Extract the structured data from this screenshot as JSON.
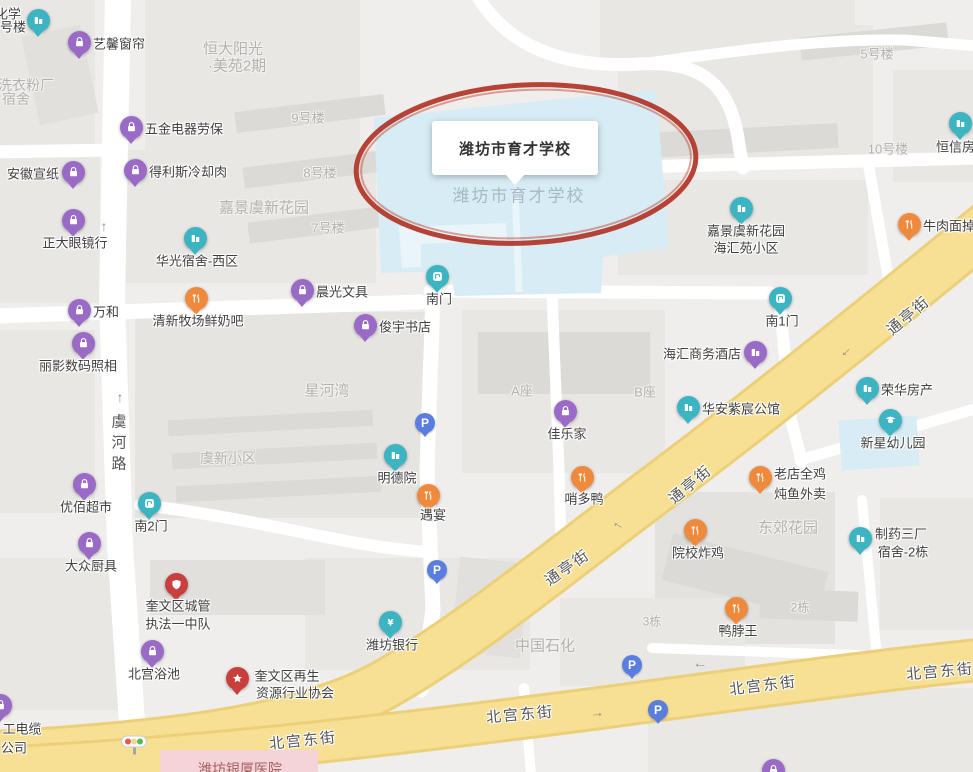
{
  "school": {
    "callout_label": "潍坊市育才学校",
    "ghost_label": "潍坊市育才学校"
  },
  "colors": {
    "pin_purple": "#9a6bc6",
    "pin_teal": "#3db4c2",
    "pin_orange": "#ef8a3d",
    "pin_red": "#c8403e",
    "parking_blue": "#5a7de0",
    "road_yellow": "#f7e093",
    "campus_blue": "#d7ecf4",
    "highlight_ellipse": "#b3392c",
    "hospital_pink": "#f4d4d9"
  },
  "pois": [
    {
      "id": "chem-dorm",
      "lines": [
        {
          "t": "化学",
          "x": 8,
          "y": 13
        },
        {
          "t": "号楼",
          "x": 13,
          "y": 26
        }
      ],
      "icon": "building",
      "color": "teal",
      "x": 38,
      "y": 20
    },
    {
      "id": "yixin-curtains",
      "label": "艺馨窗帘",
      "icon": "bag",
      "color": "purple",
      "x": 79,
      "y": 42,
      "lp": "r"
    },
    {
      "id": "wujin-labor",
      "label": "五金电器劳保",
      "icon": "bag",
      "color": "purple",
      "x": 131,
      "y": 127,
      "lp": "r"
    },
    {
      "id": "anhui-paper",
      "label": "安徽宣纸",
      "icon": "bag",
      "color": "purple",
      "x": 73,
      "y": 172,
      "lp": "l"
    },
    {
      "id": "delisi-meat",
      "label": "得利斯冷却肉",
      "icon": "bag",
      "color": "purple",
      "x": 135,
      "y": 170,
      "lp": "r"
    },
    {
      "id": "zhengda-glasses",
      "label": "正大眼镜行",
      "icon": "bag",
      "color": "purple",
      "x": 73,
      "y": 220,
      "lp": "b"
    },
    {
      "id": "wanhe",
      "label": "万和",
      "icon": "bag",
      "color": "purple",
      "x": 79,
      "y": 310,
      "lp": "r"
    },
    {
      "id": "liying-photo",
      "label": "丽影数码照相",
      "icon": "bag",
      "color": "purple",
      "x": 83,
      "y": 343,
      "lp": "b",
      "lx": 78,
      "ly": 365
    },
    {
      "id": "chenguang-stationery",
      "label": "晨光文具",
      "icon": "bag",
      "color": "purple",
      "x": 302,
      "y": 290,
      "lp": "r"
    },
    {
      "id": "junyu-bookstore",
      "label": "俊宇书店",
      "icon": "bag",
      "color": "purple",
      "x": 365,
      "y": 325,
      "lp": "r"
    },
    {
      "id": "youbai-market",
      "label": "优佰超市",
      "icon": "bag",
      "color": "purple",
      "x": 84,
      "y": 484,
      "lp": "b"
    },
    {
      "id": "dazhong-kitchen",
      "label": "大众厨具",
      "icon": "bag",
      "color": "purple",
      "x": 89,
      "y": 543,
      "lp": "b"
    },
    {
      "id": "jialejia",
      "label": "佳乐家",
      "icon": "bag",
      "color": "purple",
      "x": 565,
      "y": 411,
      "lp": "b"
    },
    {
      "id": "haihui-hotel",
      "label": "海汇商务酒店",
      "icon": "building",
      "color": "purple",
      "x": 755,
      "y": 352,
      "lp": "l"
    },
    {
      "id": "beigong-bath",
      "label": "北宫浴池",
      "icon": "bag",
      "color": "purple",
      "x": 152,
      "y": 651,
      "lp": "b"
    },
    {
      "id": "cable-company",
      "lines": [
        {
          "t": "工电缆",
          "x": 22,
          "y": 728
        },
        {
          "t": "公司",
          "x": 14,
          "y": 747
        }
      ],
      "icon": "bag",
      "color": "purple",
      "x": 0,
      "y": 705
    },
    {
      "id": "edge-shop",
      "icon": "bag",
      "color": "purple",
      "x": 773,
      "y": 770
    },
    {
      "id": "huaguang-dorm",
      "label": "华光宿舍-西区",
      "icon": "building",
      "color": "teal",
      "x": 195,
      "y": 238,
      "lp": "b"
    },
    {
      "id": "mingde-yuan",
      "label": "明德院",
      "icon": "building",
      "color": "teal",
      "x": 395,
      "y": 455,
      "lp": "b"
    },
    {
      "id": "south-gate",
      "label": "南门",
      "icon": "gate",
      "color": "teal",
      "x": 437,
      "y": 276,
      "lp": "b"
    },
    {
      "id": "south-gate-2",
      "label": "南2门",
      "icon": "gate",
      "color": "teal",
      "x": 149,
      "y": 503,
      "lp": "b"
    },
    {
      "id": "south-gate-1",
      "label": "南1门",
      "icon": "gate",
      "color": "teal",
      "x": 780,
      "y": 298,
      "lp": "b"
    },
    {
      "id": "jiajing-haihuiyuan",
      "lines": [
        {
          "t": "嘉景虞新花园",
          "x": 746,
          "y": 230
        },
        {
          "t": "海汇苑小区",
          "x": 746,
          "y": 247
        }
      ],
      "icon": "building",
      "color": "teal",
      "x": 741,
      "y": 208
    },
    {
      "id": "hengxin-realty",
      "label": "恒信房产",
      "icon": "building",
      "color": "teal",
      "x": 960,
      "y": 123,
      "lp": "b",
      "lx": 962,
      "ly": 146
    },
    {
      "id": "huaan-mansion",
      "label": "华安紫宸公馆",
      "icon": "building",
      "color": "teal",
      "x": 688,
      "y": 407,
      "lp": "r"
    },
    {
      "id": "ronghua-realty",
      "label": "荣华房产",
      "icon": "building",
      "color": "teal",
      "x": 867,
      "y": 388,
      "lp": "r"
    },
    {
      "id": "xinxing-kindergarten",
      "label": "新星幼儿园",
      "icon": "cap",
      "color": "teal",
      "x": 890,
      "y": 420,
      "lp": "b",
      "lx": 893,
      "ly": 442
    },
    {
      "id": "zhiyao-dorm",
      "lines": [
        {
          "t": "制药三厂",
          "x": 901,
          "y": 533
        },
        {
          "t": "宿舍-2栋",
          "x": 903,
          "y": 551
        }
      ],
      "icon": "building",
      "color": "teal",
      "x": 860,
      "y": 538
    },
    {
      "id": "weifang-bank",
      "label": "潍坊银行",
      "icon": "bank",
      "color": "teal",
      "x": 390,
      "y": 622,
      "lp": "b"
    },
    {
      "id": "qingxin-milk-bar",
      "label": "清新牧场鲜奶吧",
      "icon": "food",
      "color": "orange",
      "x": 196,
      "y": 298,
      "lp": "b"
    },
    {
      "id": "yuyan",
      "label": "遇宴",
      "icon": "food",
      "color": "orange",
      "x": 428,
      "y": 495,
      "lp": "b",
      "lx": 433,
      "ly": 514
    },
    {
      "id": "shaoduoya",
      "label": "哨多鸭",
      "icon": "food",
      "color": "orange",
      "x": 582,
      "y": 477,
      "lp": "b",
      "lx": 584,
      "ly": 498
    },
    {
      "id": "laodian-chicken",
      "lines": [
        {
          "t": "老店全鸡",
          "x": 800,
          "y": 473
        },
        {
          "t": "炖鱼外卖",
          "x": 800,
          "y": 493
        }
      ],
      "icon": "food",
      "color": "orange",
      "x": 760,
      "y": 477
    },
    {
      "id": "beef-noodle",
      "label": "牛肉面掉渣",
      "icon": "food",
      "color": "orange",
      "x": 909,
      "y": 224,
      "lp": "r"
    },
    {
      "id": "yuanxiao-fried-chicken",
      "label": "院校炸鸡",
      "icon": "food",
      "color": "orange",
      "x": 695,
      "y": 530,
      "lp": "b",
      "lx": 698,
      "ly": 552
    },
    {
      "id": "yabowang",
      "label": "鸭脖王",
      "icon": "food",
      "color": "orange",
      "x": 736,
      "y": 608,
      "lp": "b",
      "lx": 738,
      "ly": 630
    },
    {
      "id": "chengguan-brigade",
      "lines": [
        {
          "t": "奎文区城管",
          "x": 178,
          "y": 605
        },
        {
          "t": "执法一中队",
          "x": 178,
          "y": 623
        }
      ],
      "icon": "badge",
      "color": "red",
      "x": 176,
      "y": 584
    },
    {
      "id": "recycling-association",
      "lines": [
        {
          "t": "奎文区再生",
          "x": 287,
          "y": 675
        },
        {
          "t": "资源行业协会",
          "x": 295,
          "y": 692
        }
      ],
      "icon": "star",
      "color": "red",
      "x": 237,
      "y": 678
    }
  ],
  "parking_icons": [
    {
      "x": 425,
      "y": 423
    },
    {
      "x": 437,
      "y": 570
    },
    {
      "x": 632,
      "y": 665
    },
    {
      "x": 658,
      "y": 710
    }
  ],
  "area_labels": [
    {
      "t": "恒大阳光",
      "x": 233,
      "y": 48,
      "s": 15
    },
    {
      "t": "·美苑2期",
      "x": 237,
      "y": 65,
      "s": 15
    },
    {
      "t": "洗衣粉厂",
      "x": 26,
      "y": 85,
      "s": 14
    },
    {
      "t": "宿舍",
      "x": 16,
      "y": 99,
      "s": 14
    },
    {
      "t": "9号楼",
      "x": 308,
      "y": 117,
      "s": 13
    },
    {
      "t": "8号楼",
      "x": 320,
      "y": 172,
      "s": 13
    },
    {
      "t": "嘉景虞新花园",
      "x": 264,
      "y": 207,
      "s": 15
    },
    {
      "t": "7号楼",
      "x": 328,
      "y": 227,
      "s": 13
    },
    {
      "t": "5号楼",
      "x": 877,
      "y": 53,
      "s": 13
    },
    {
      "t": "10号楼",
      "x": 888,
      "y": 148,
      "s": 13
    },
    {
      "t": "8号楼",
      "x": 990,
      "y": 15,
      "s": 13
    },
    {
      "t": "星河湾",
      "x": 327,
      "y": 390,
      "s": 15
    },
    {
      "t": "A座",
      "x": 522,
      "y": 390,
      "s": 13
    },
    {
      "t": "B座",
      "x": 645,
      "y": 391,
      "s": 13
    },
    {
      "t": "虞新小区",
      "x": 228,
      "y": 458,
      "s": 14
    },
    {
      "t": "东郊花园",
      "x": 788,
      "y": 527,
      "s": 15
    },
    {
      "t": "中国石化",
      "x": 545,
      "y": 645,
      "s": 15
    },
    {
      "t": "2栋",
      "x": 800,
      "y": 607,
      "s": 12
    },
    {
      "t": "3栋",
      "x": 652,
      "y": 621,
      "s": 12
    },
    {
      "t": "潍坊银厦医院",
      "x": 240,
      "y": 769,
      "s": 14,
      "cls": "hospital"
    }
  ],
  "road_labels": [
    {
      "t": "虞河路",
      "x": 118,
      "y": 445,
      "vertical": true
    },
    {
      "t": "通亭街",
      "x": 908,
      "y": 315,
      "rot": -40
    },
    {
      "t": "通亭街",
      "x": 690,
      "y": 484,
      "rot": -40
    },
    {
      "t": "通亭街",
      "x": 567,
      "y": 567,
      "rot": -35
    },
    {
      "t": "北宫东街",
      "x": 303,
      "y": 740,
      "rot": -6
    },
    {
      "t": "北宫东街",
      "x": 520,
      "y": 714,
      "rot": -5
    },
    {
      "t": "北宫东街",
      "x": 763,
      "y": 685,
      "rot": -7
    },
    {
      "t": "北宫东街",
      "x": 940,
      "y": 671,
      "rot": -5
    }
  ],
  "arrows": [
    {
      "g": "↑",
      "x": 104,
      "y": 226,
      "rot": 0
    },
    {
      "g": "↑",
      "x": 120,
      "y": 397,
      "rot": 0
    },
    {
      "g": "→",
      "x": 848,
      "y": 354,
      "rot": 137
    },
    {
      "g": "→",
      "x": 617,
      "y": 528,
      "rot": 205
    },
    {
      "g": "→",
      "x": 700,
      "y": 668,
      "rot": 185
    },
    {
      "g": "→",
      "x": 597,
      "y": 712,
      "rot": -6
    }
  ]
}
